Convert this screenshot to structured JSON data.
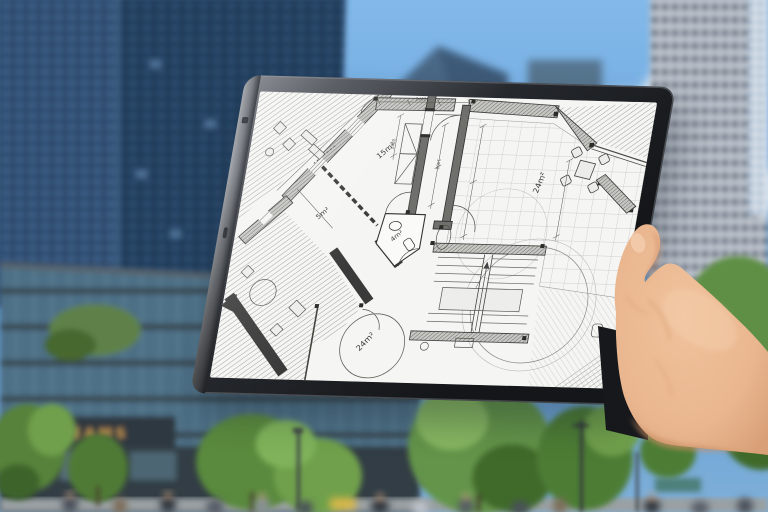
{
  "scene": {
    "tablet": {
      "floor_plan": {
        "room_labels": [
          "15m²",
          "5m²",
          "4m²",
          "24m²",
          "24m²"
        ],
        "dim_labels": [
          "2400",
          "1400",
          "1400"
        ]
      }
    },
    "background": {
      "storefront_sign": "BEAMS"
    },
    "icons": {
      "side_camera_dot": "▪",
      "side_port": "▬"
    },
    "colors": {
      "sky": "#6FAADF",
      "cloud": "#FFFFFF",
      "left_tower": "#2E4A6A",
      "right_tower": "#C7CDD6",
      "glass_building": "#4E7086",
      "brick": "#9B6143",
      "tree": "#5E8F45",
      "tablet_frame": "#1B1E23",
      "tablet_edge": "#8A8D92",
      "plan_paper": "#F5F5F3",
      "plan_wall": "#6F6F6B",
      "skin": "#E9B68F",
      "sign_gold": "#C99A4F"
    }
  }
}
